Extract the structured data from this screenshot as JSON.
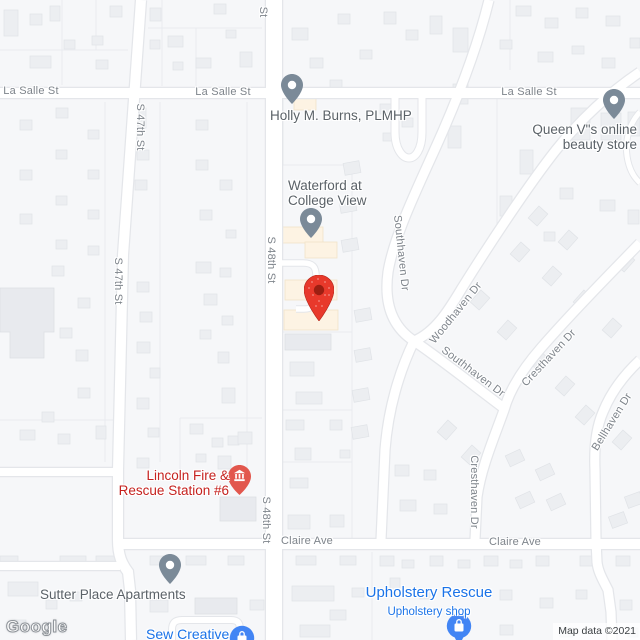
{
  "watermark": "Google",
  "attribution": "Map data ©2021",
  "streets": {
    "la_salle_1": "La Salle St",
    "la_salle_2": "La Salle St",
    "la_salle_3": "La Salle St",
    "s47_1": "S 47th St",
    "s47_2": "S 47th St",
    "s48_top": "St",
    "s48_1": "S 48th St",
    "s48_2": "S 48th St",
    "southhaven_1": "Southhaven Dr",
    "southhaven_2": "Southhaven Dr",
    "woodhaven": "Woodhaven Dr",
    "cresthaven_1": "Cresthaven Dr",
    "cresthaven_2": "Cresthaven Dr",
    "bellhaven": "Bellhaven Dr",
    "claire_1": "Claire Ave",
    "claire_2": "Claire Ave"
  },
  "pois": {
    "holly": {
      "name": "Holly M. Burns, PLMHP"
    },
    "queen": {
      "line1": "Queen V\"s online",
      "line2": "beauty store"
    },
    "waterford": {
      "line1": "Waterford at",
      "line2": "College View"
    },
    "lincoln": {
      "line1": "Lincoln Fire &",
      "line2": "Rescue Station #6"
    },
    "sutter": {
      "name": "Sutter Place Apartments"
    },
    "upholstery": {
      "name": "Upholstery Rescue",
      "subtitle": "Upholstery shop"
    },
    "sew": {
      "name": "Sew Creative"
    }
  },
  "colors": {
    "marker_red": "#e8392b",
    "poi_red": "#c5221f",
    "poi_blue": "#1a73e8",
    "pin_blue": "#4285f4",
    "pin_gray": "#7b8a98",
    "road": "#ffffff",
    "land": "#f6f7f9"
  }
}
